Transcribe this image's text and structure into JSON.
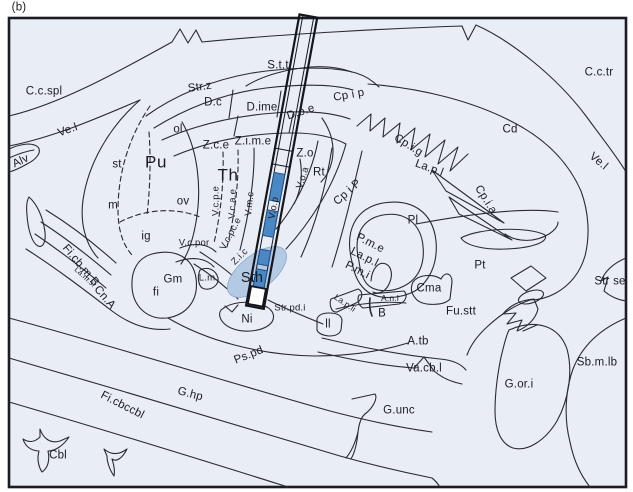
{
  "figure": {
    "panel_label": "(b)",
    "labels": {
      "ccspl": {
        "text": "C.c.spl"
      },
      "vel_left": {
        "text": "Ve.l"
      },
      "alv": {
        "text": "Alv"
      },
      "strz": {
        "text": "Str.z"
      },
      "dc": {
        "text": "D.c"
      },
      "dime": {
        "text": "D.ime"
      },
      "doe": {
        "text": "D.o.e"
      },
      "stt": {
        "text": "S.t.t"
      },
      "cpip_top": {
        "text": "Cp i p"
      },
      "cctr": {
        "text": "C.c.tr"
      },
      "ol": {
        "text": "ol"
      },
      "zce": {
        "text": "Z.c.e"
      },
      "zime": {
        "text": "Z.i.m.e"
      },
      "zo": {
        "text": "Z.o"
      },
      "cd": {
        "text": "Cd"
      },
      "cpig": {
        "text": "Cp.i.g"
      },
      "vel_right": {
        "text": "Ve.l"
      },
      "st": {
        "text": "st"
      },
      "pu": {
        "text": "Pu"
      },
      "th": {
        "text": "Th"
      },
      "rt": {
        "text": "Rt"
      },
      "lapl_top": {
        "text": "La.p.l"
      },
      "cpia": {
        "text": "Cp.i.a"
      },
      "m": {
        "text": "m"
      },
      "ov": {
        "text": "ov"
      },
      "vcpe": {
        "text": "V.c.p.e"
      },
      "vcae": {
        "text": "V.c.a.e"
      },
      "vmc": {
        "text": "V.m.c"
      },
      "vop": {
        "text": "V.o.p"
      },
      "voa": {
        "text": "V.o.a"
      },
      "cpiP": {
        "text": "Cp i P"
      },
      "pl": {
        "text": "Pl"
      },
      "ig": {
        "text": "ig"
      },
      "vcpor": {
        "text": "V.c.por"
      },
      "vcpce": {
        "text": "V.c.pc.e"
      },
      "zic": {
        "text": "Z.i.c"
      },
      "pme": {
        "text": "P.m.e"
      },
      "lapl_low": {
        "text": "La.p.l"
      },
      "pmi": {
        "text": "P.m.i"
      },
      "pt": {
        "text": "Pt"
      },
      "ficbmb": {
        "text": "Fi.cb.m.B"
      },
      "lamsl": {
        "text": "La.m.sl"
      },
      "cna": {
        "text": "Cn.A"
      },
      "gm": {
        "text": "Gm"
      },
      "fi": {
        "text": "fi"
      },
      "lm": {
        "text": "L.m"
      },
      "sth": {
        "text": "Sth"
      },
      "strpdi": {
        "text": "Str.pd.i"
      },
      "ni": {
        "text": "Ni"
      },
      "anl": {
        "text": "A.n.l"
      },
      "lapli": {
        "text": "La.p.li"
      },
      "b_area": {
        "text": "B"
      },
      "cma": {
        "text": "Cma"
      },
      "fustt": {
        "text": "Fu.stt"
      },
      "strse": {
        "text": "Str se"
      },
      "ll": {
        "text": "ll"
      },
      "atb": {
        "text": "A.tb"
      },
      "vacbl": {
        "text": "Va.cb.l"
      },
      "sbmlb": {
        "text": "Sb.m.lb"
      },
      "pspd": {
        "text": "Ps.pd"
      },
      "ghp": {
        "text": "G.hp"
      },
      "ficbccbl": {
        "text": "Fi.cbccbl"
      },
      "gori": {
        "text": "G.or.i"
      },
      "gunc": {
        "text": "G.unc"
      },
      "cbl": {
        "text": "Cbl"
      }
    }
  },
  "electrode": {
    "contact_count": 4,
    "highlighted_region": "Sth"
  },
  "colors": {
    "background": "#e9edf5",
    "line": "#2a2a33",
    "frame": "#1c1c24",
    "contact_blue": "#4a87c5",
    "sth_light_blue": "#b3c9e4"
  }
}
